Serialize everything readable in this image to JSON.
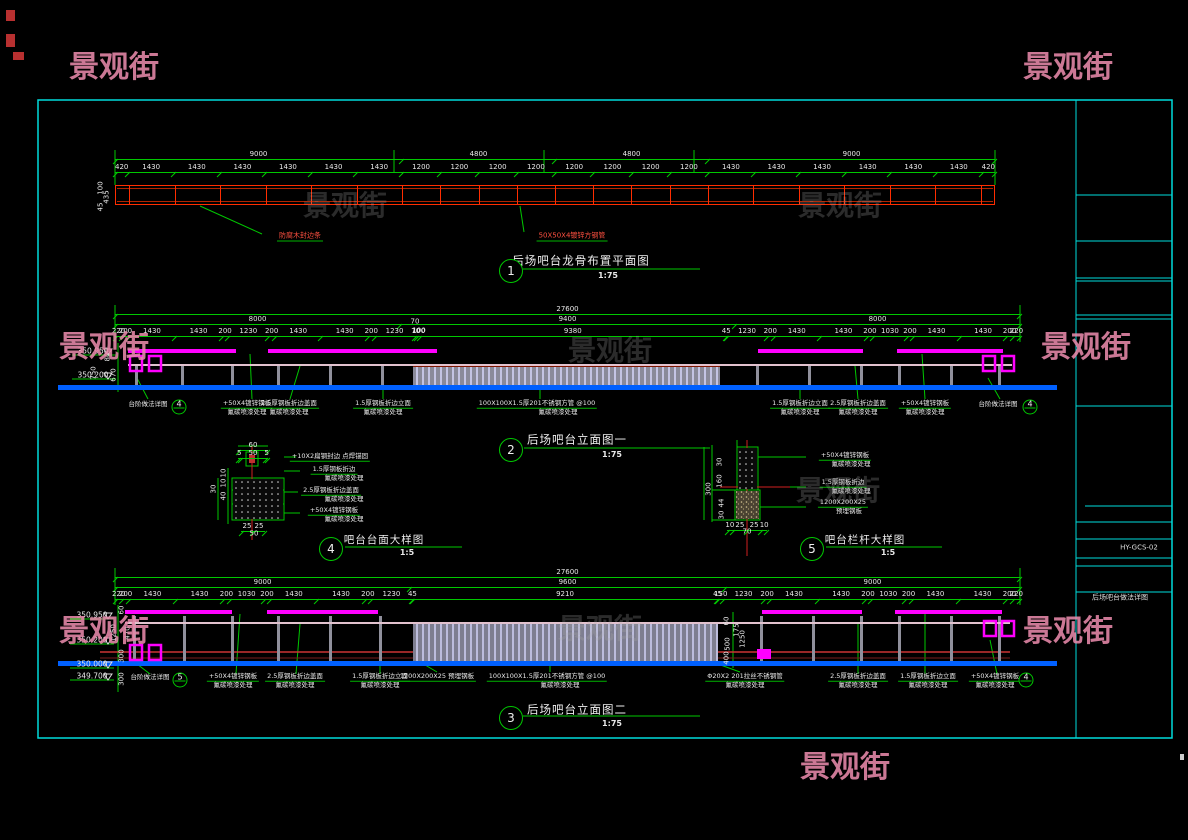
{
  "watermark_text": "景观街",
  "title_block": {
    "drawing_no": "HY-GCS-02",
    "drawing_title": "后场吧台做法详图"
  },
  "view_titles": [
    {
      "no": "1",
      "label": "后场吧台龙骨布置平面图",
      "scale": "1:75"
    },
    {
      "no": "2",
      "label": "后场吧台立面图一",
      "scale": "1:75"
    },
    {
      "no": "3",
      "label": "后场吧台立面图二",
      "scale": "1:75"
    },
    {
      "no": "4",
      "label": "吧台台面大样图",
      "scale": "1:5"
    },
    {
      "no": "5",
      "label": "吧台栏杆大样图",
      "scale": "1:5"
    }
  ],
  "plan_bar": {
    "x": 115,
    "y": 185,
    "w": 880,
    "h": 20,
    "segments": [
      420,
      1430,
      1430,
      1430,
      1430,
      1430,
      1430,
      1200,
      1200,
      1200,
      1200,
      1200,
      1200,
      1200,
      1200,
      1430,
      1430,
      1430,
      1430,
      1430,
      1430,
      420
    ]
  },
  "dimrows": [
    {
      "x": 115,
      "y": 150,
      "w": 880,
      "v": [
        "9000",
        "4800",
        "4800",
        "9000"
      ]
    },
    {
      "x": 115,
      "y": 163,
      "w": 880,
      "v": [
        "420",
        "1430",
        "1430",
        "1430",
        "1430",
        "1430",
        "1430",
        "1200",
        "1200",
        "1200",
        "1200",
        "1200",
        "1200",
        "1200",
        "1200",
        "1430",
        "1430",
        "1430",
        "1430",
        "1430",
        "1430",
        "420"
      ]
    },
    {
      "x": 115,
      "y": 305,
      "w": 905,
      "v": [
        "27600"
      ]
    },
    {
      "x": 115,
      "y": 315,
      "w": 905,
      "v": [
        "8000",
        "9400",
        "8000"
      ]
    },
    {
      "x": 115,
      "y": 327,
      "w": 905,
      "v": [
        "220",
        "200",
        "1430",
        "1430",
        "200",
        "1230",
        "200",
        "1430",
        "1430",
        "200",
        "1230",
        "70",
        "100",
        "9380",
        "45",
        "1230",
        "200",
        "1430",
        "1430",
        "200",
        "1030",
        "200",
        "1430",
        "1430",
        "200",
        "220"
      ]
    },
    {
      "x": 115,
      "y": 568,
      "w": 905,
      "v": [
        "27600"
      ]
    },
    {
      "x": 115,
      "y": 578,
      "w": 905,
      "v": [
        "9000",
        "9600",
        "9000"
      ]
    },
    {
      "x": 115,
      "y": 590,
      "w": 905,
      "v": [
        "220",
        "200",
        "1430",
        "1430",
        "200",
        "1030",
        "200",
        "1430",
        "1430",
        "200",
        "1230",
        "45",
        "9210",
        "45",
        "150",
        "1230",
        "200",
        "1430",
        "1430",
        "200",
        "1030",
        "200",
        "1430",
        "1430",
        "200",
        "220"
      ]
    },
    {
      "x": 238,
      "y": 441,
      "w": 30,
      "v": [
        "60"
      ]
    },
    {
      "x": 238,
      "y": 449,
      "w": 30,
      "v": [
        "5",
        "50",
        "5"
      ]
    },
    {
      "x": 241,
      "y": 522,
      "w": 24,
      "v": [
        "25",
        "25"
      ]
    },
    {
      "x": 727,
      "y": 521,
      "w": 40,
      "v": [
        "10",
        "25",
        "25",
        "10"
      ]
    }
  ],
  "texts": [
    {
      "x": 101,
      "y": 188,
      "t": "100",
      "c": "d",
      "r": 1
    },
    {
      "x": 107,
      "y": 197,
      "t": "435",
      "c": "d",
      "r": 1
    },
    {
      "x": 101,
      "y": 207,
      "t": "45",
      "c": "d",
      "r": 1
    },
    {
      "x": 300,
      "y": 237,
      "t": "防腐木封边条",
      "c": "rd u",
      "n": "plan-label"
    },
    {
      "x": 572,
      "y": 237,
      "t": "50X50X4镀锌方钢管",
      "c": "rd u",
      "n": "plan-label"
    },
    {
      "x": 581,
      "y": 261,
      "t": "后场吧台龙骨布置平面图",
      "c": "tt",
      "n": "view-title"
    },
    {
      "x": 608,
      "y": 276,
      "t": "1:75",
      "c": "sc",
      "n": "view-scale"
    },
    {
      "x": 415,
      "y": 322,
      "t": "70",
      "c": "d"
    },
    {
      "x": 419,
      "y": 331,
      "t": "100",
      "c": "d"
    },
    {
      "x": 93,
      "y": 351,
      "t": "350.950",
      "c": "lv",
      "n": "level-mark"
    },
    {
      "x": 93,
      "y": 375,
      "t": "350.200",
      "c": "lv",
      "n": "level-mark"
    },
    {
      "x": 108,
      "y": 357,
      "t": "80",
      "c": "d",
      "r": 1
    },
    {
      "x": 94,
      "y": 373,
      "t": "750",
      "c": "d",
      "r": 1
    },
    {
      "x": 114,
      "y": 375,
      "t": "670",
      "c": "d",
      "r": 1
    },
    {
      "x": 148,
      "y": 404,
      "t": "台阶做法详图",
      "c": "lb"
    },
    {
      "x": 247,
      "y": 404,
      "t": "+50X4镀锌钢板",
      "c": "lb u"
    },
    {
      "x": 247,
      "y": 412,
      "t": "氟碳喷漆处理",
      "c": "lb"
    },
    {
      "x": 289,
      "y": 404,
      "t": "2.5厚钢板折边盖面",
      "c": "lb u"
    },
    {
      "x": 289,
      "y": 412,
      "t": "氟碳喷漆处理",
      "c": "lb"
    },
    {
      "x": 383,
      "y": 404,
      "t": "1.5厚钢板折边立面",
      "c": "lb u"
    },
    {
      "x": 383,
      "y": 412,
      "t": "氟碳喷漆处理",
      "c": "lb"
    },
    {
      "x": 537,
      "y": 404,
      "t": "100X100X1.5厚201不锈钢方管 @100",
      "c": "lb u"
    },
    {
      "x": 558,
      "y": 412,
      "t": "氟碳喷漆处理",
      "c": "lb"
    },
    {
      "x": 800,
      "y": 404,
      "t": "1.5厚钢板折边立面",
      "c": "lb u"
    },
    {
      "x": 800,
      "y": 412,
      "t": "氟碳喷漆处理",
      "c": "lb"
    },
    {
      "x": 858,
      "y": 404,
      "t": "2.5厚钢板折边盖面",
      "c": "lb u"
    },
    {
      "x": 858,
      "y": 412,
      "t": "氟碳喷漆处理",
      "c": "lb"
    },
    {
      "x": 925,
      "y": 404,
      "t": "+50X4镀锌钢板",
      "c": "lb u"
    },
    {
      "x": 925,
      "y": 412,
      "t": "氟碳喷漆处理",
      "c": "lb"
    },
    {
      "x": 998,
      "y": 404,
      "t": "台阶做法详图",
      "c": "lb"
    },
    {
      "x": 577,
      "y": 440,
      "t": "后场吧台立面图一",
      "c": "tt",
      "n": "view-title"
    },
    {
      "x": 612,
      "y": 455,
      "t": "1:75",
      "c": "sc",
      "n": "view-scale"
    },
    {
      "x": 224,
      "y": 473,
      "t": "10",
      "c": "d",
      "r": 1
    },
    {
      "x": 224,
      "y": 483,
      "t": "10",
      "c": "d",
      "r": 1
    },
    {
      "x": 224,
      "y": 496,
      "t": "40",
      "c": "d",
      "r": 1
    },
    {
      "x": 214,
      "y": 489,
      "t": "30",
      "c": "d",
      "r": 1
    },
    {
      "x": 254,
      "y": 534,
      "t": "50",
      "c": "d"
    },
    {
      "x": 330,
      "y": 457,
      "t": "+10X2扁钢封边 点焊锚固",
      "c": "lb u"
    },
    {
      "x": 334,
      "y": 470,
      "t": "1.5厚钢板折边",
      "c": "lb u"
    },
    {
      "x": 344,
      "y": 478,
      "t": "氟碳喷漆处理",
      "c": "lb"
    },
    {
      "x": 331,
      "y": 491,
      "t": "2.5厚钢板折边盖面",
      "c": "lb u"
    },
    {
      "x": 344,
      "y": 499,
      "t": "氟碳喷漆处理",
      "c": "lb"
    },
    {
      "x": 334,
      "y": 511,
      "t": "+50X4镀锌钢板",
      "c": "lb u"
    },
    {
      "x": 344,
      "y": 519,
      "t": "氟碳喷漆处理",
      "c": "lb"
    },
    {
      "x": 384,
      "y": 540,
      "t": "吧台台面大样图",
      "c": "tt2",
      "n": "view-title"
    },
    {
      "x": 407,
      "y": 553,
      "t": "1:5",
      "c": "sc",
      "n": "view-scale"
    },
    {
      "x": 720,
      "y": 462,
      "t": "30",
      "c": "d",
      "r": 1
    },
    {
      "x": 720,
      "y": 481,
      "t": "160",
      "c": "d",
      "r": 1
    },
    {
      "x": 722,
      "y": 503,
      "t": "44",
      "c": "d",
      "r": 1
    },
    {
      "x": 722,
      "y": 515,
      "t": "30",
      "c": "d",
      "r": 1
    },
    {
      "x": 709,
      "y": 489,
      "t": "300",
      "c": "d",
      "r": 1
    },
    {
      "x": 747,
      "y": 532,
      "t": "70",
      "c": "d"
    },
    {
      "x": 845,
      "y": 456,
      "t": "+50X4镀锌钢板",
      "c": "lb u"
    },
    {
      "x": 851,
      "y": 464,
      "t": "氟碳喷漆处理",
      "c": "lb"
    },
    {
      "x": 843,
      "y": 483,
      "t": "1.5厚钢板折边",
      "c": "lb u"
    },
    {
      "x": 851,
      "y": 491,
      "t": "氟碳喷漆处理",
      "c": "lb"
    },
    {
      "x": 843,
      "y": 503,
      "t": "1200X200X25",
      "c": "lb u"
    },
    {
      "x": 849,
      "y": 511,
      "t": "预埋钢板",
      "c": "lb"
    },
    {
      "x": 865,
      "y": 540,
      "t": "吧台栏杆大样图",
      "c": "tt2",
      "n": "view-title"
    },
    {
      "x": 888,
      "y": 553,
      "t": "1:5",
      "c": "sc",
      "n": "view-scale"
    },
    {
      "x": 92,
      "y": 615,
      "t": "350.950",
      "c": "lv",
      "n": "level-mark"
    },
    {
      "x": 92,
      "y": 640,
      "t": "350.200",
      "c": "lv",
      "n": "level-mark"
    },
    {
      "x": 92,
      "y": 664,
      "t": "350.000",
      "c": "lv",
      "n": "level-mark"
    },
    {
      "x": 92,
      "y": 676,
      "t": "349.700",
      "c": "lv",
      "n": "level-mark"
    },
    {
      "x": 122,
      "y": 610,
      "t": "60",
      "c": "d",
      "r": 1
    },
    {
      "x": 114,
      "y": 633,
      "t": "1250",
      "c": "d",
      "r": 1
    },
    {
      "x": 128,
      "y": 633,
      "t": "470",
      "c": "d",
      "r": 1
    },
    {
      "x": 122,
      "y": 656,
      "t": "300",
      "c": "d",
      "r": 1
    },
    {
      "x": 122,
      "y": 679,
      "t": "300",
      "c": "d",
      "r": 1
    },
    {
      "x": 727,
      "y": 621,
      "t": "60",
      "c": "d",
      "r": 1
    },
    {
      "x": 737,
      "y": 630,
      "t": "175",
      "c": "d",
      "r": 1
    },
    {
      "x": 728,
      "y": 644,
      "t": "500",
      "c": "d",
      "r": 1
    },
    {
      "x": 727,
      "y": 658,
      "t": "400",
      "c": "d",
      "r": 1
    },
    {
      "x": 743,
      "y": 639,
      "t": "1250",
      "c": "d",
      "r": 1
    },
    {
      "x": 150,
      "y": 677,
      "t": "台阶做法详图",
      "c": "lb"
    },
    {
      "x": 233,
      "y": 677,
      "t": "+50X4镀锌钢板",
      "c": "lb u"
    },
    {
      "x": 233,
      "y": 685,
      "t": "氟碳喷漆处理",
      "c": "lb"
    },
    {
      "x": 295,
      "y": 677,
      "t": "2.5厚钢板折边盖面",
      "c": "lb u"
    },
    {
      "x": 295,
      "y": 685,
      "t": "氟碳喷漆处理",
      "c": "lb"
    },
    {
      "x": 380,
      "y": 677,
      "t": "1.5厚钢板折边立面",
      "c": "lb u"
    },
    {
      "x": 380,
      "y": 685,
      "t": "氟碳喷漆处理",
      "c": "lb"
    },
    {
      "x": 437,
      "y": 677,
      "t": "1200X200X25 预埋钢板",
      "c": "lb u"
    },
    {
      "x": 547,
      "y": 677,
      "t": "100X100X1.5厚201不锈钢方管 @100",
      "c": "lb u"
    },
    {
      "x": 560,
      "y": 685,
      "t": "氟碳喷漆处理",
      "c": "lb"
    },
    {
      "x": 745,
      "y": 677,
      "t": "Φ20X2 201拉丝不锈钢管",
      "c": "lb u"
    },
    {
      "x": 745,
      "y": 685,
      "t": "氟碳喷漆处理",
      "c": "lb"
    },
    {
      "x": 858,
      "y": 677,
      "t": "2.5厚钢板折边盖面",
      "c": "lb u"
    },
    {
      "x": 858,
      "y": 685,
      "t": "氟碳喷漆处理",
      "c": "lb"
    },
    {
      "x": 928,
      "y": 677,
      "t": "1.5厚钢板折边立面",
      "c": "lb u"
    },
    {
      "x": 928,
      "y": 685,
      "t": "氟碳喷漆处理",
      "c": "lb"
    },
    {
      "x": 995,
      "y": 677,
      "t": "+50X4镀锌钢板",
      "c": "lb u"
    },
    {
      "x": 995,
      "y": 685,
      "t": "氟碳喷漆处理",
      "c": "lb"
    },
    {
      "x": 577,
      "y": 710,
      "t": "后场吧台立面图二",
      "c": "tt",
      "n": "view-title"
    },
    {
      "x": 612,
      "y": 724,
      "t": "1:75",
      "c": "sc",
      "n": "view-scale"
    }
  ],
  "circles": [
    {
      "x": 511,
      "y": 271,
      "t": "1",
      "b": 1
    },
    {
      "x": 511,
      "y": 450,
      "t": "2",
      "b": 1
    },
    {
      "x": 511,
      "y": 718,
      "t": "3",
      "b": 1
    },
    {
      "x": 331,
      "y": 549,
      "t": "4",
      "b": 1
    },
    {
      "x": 812,
      "y": 549,
      "t": "5",
      "b": 1
    },
    {
      "x": 179,
      "y": 407,
      "t": "4"
    },
    {
      "x": 1030,
      "y": 407,
      "t": "4"
    },
    {
      "x": 180,
      "y": 680,
      "t": "5"
    },
    {
      "x": 1026,
      "y": 680,
      "t": "4"
    }
  ],
  "watermarks": [
    {
      "x": 114,
      "y": 64
    },
    {
      "x": 1068,
      "y": 64
    },
    {
      "x": 104,
      "y": 344
    },
    {
      "x": 1086,
      "y": 344
    },
    {
      "x": 104,
      "y": 628
    },
    {
      "x": 1068,
      "y": 628
    },
    {
      "x": 845,
      "y": 764
    },
    {
      "x": 345,
      "y": 204,
      "g": 1
    },
    {
      "x": 840,
      "y": 204,
      "g": 1
    },
    {
      "x": 610,
      "y": 349,
      "g": 1
    },
    {
      "x": 838,
      "y": 489,
      "g": 1
    },
    {
      "x": 600,
      "y": 627,
      "g": 1
    }
  ]
}
